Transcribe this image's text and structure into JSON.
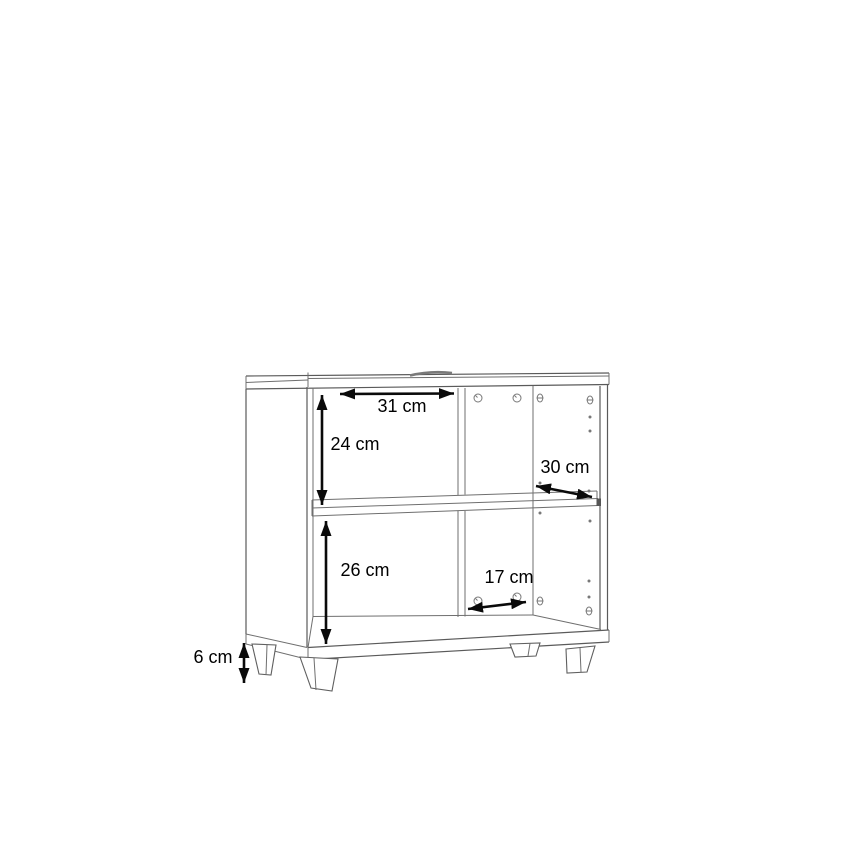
{
  "page": {
    "background": "#ffffff"
  },
  "diagram": {
    "title": "Cabinet dimension drawing",
    "object": "open two-compartment cabinet on four tapered legs with middle shelf, back panel mounting holes and shelf-pin holes",
    "unit": "cm",
    "line_color": "#6f6f6f",
    "annotation_color": "#000000",
    "dimensions": [
      {
        "id": "upper-compartment-width",
        "label": "31 cm",
        "value": 31,
        "unit": "cm",
        "orientation": "horizontal"
      },
      {
        "id": "upper-compartment-height",
        "label": "24 cm",
        "value": 24,
        "unit": "cm",
        "orientation": "vertical"
      },
      {
        "id": "cabinet-depth",
        "label": "30 cm",
        "value": 30,
        "unit": "cm",
        "orientation": "diagonal-depth"
      },
      {
        "id": "lower-compartment-height",
        "label": "26 cm",
        "value": 26,
        "unit": "cm",
        "orientation": "vertical"
      },
      {
        "id": "lower-hole-spacing",
        "label": "17 cm",
        "value": 17,
        "unit": "cm",
        "orientation": "horizontal"
      },
      {
        "id": "leg-height",
        "label": "6 cm",
        "value": 6,
        "unit": "cm",
        "orientation": "vertical"
      }
    ]
  }
}
